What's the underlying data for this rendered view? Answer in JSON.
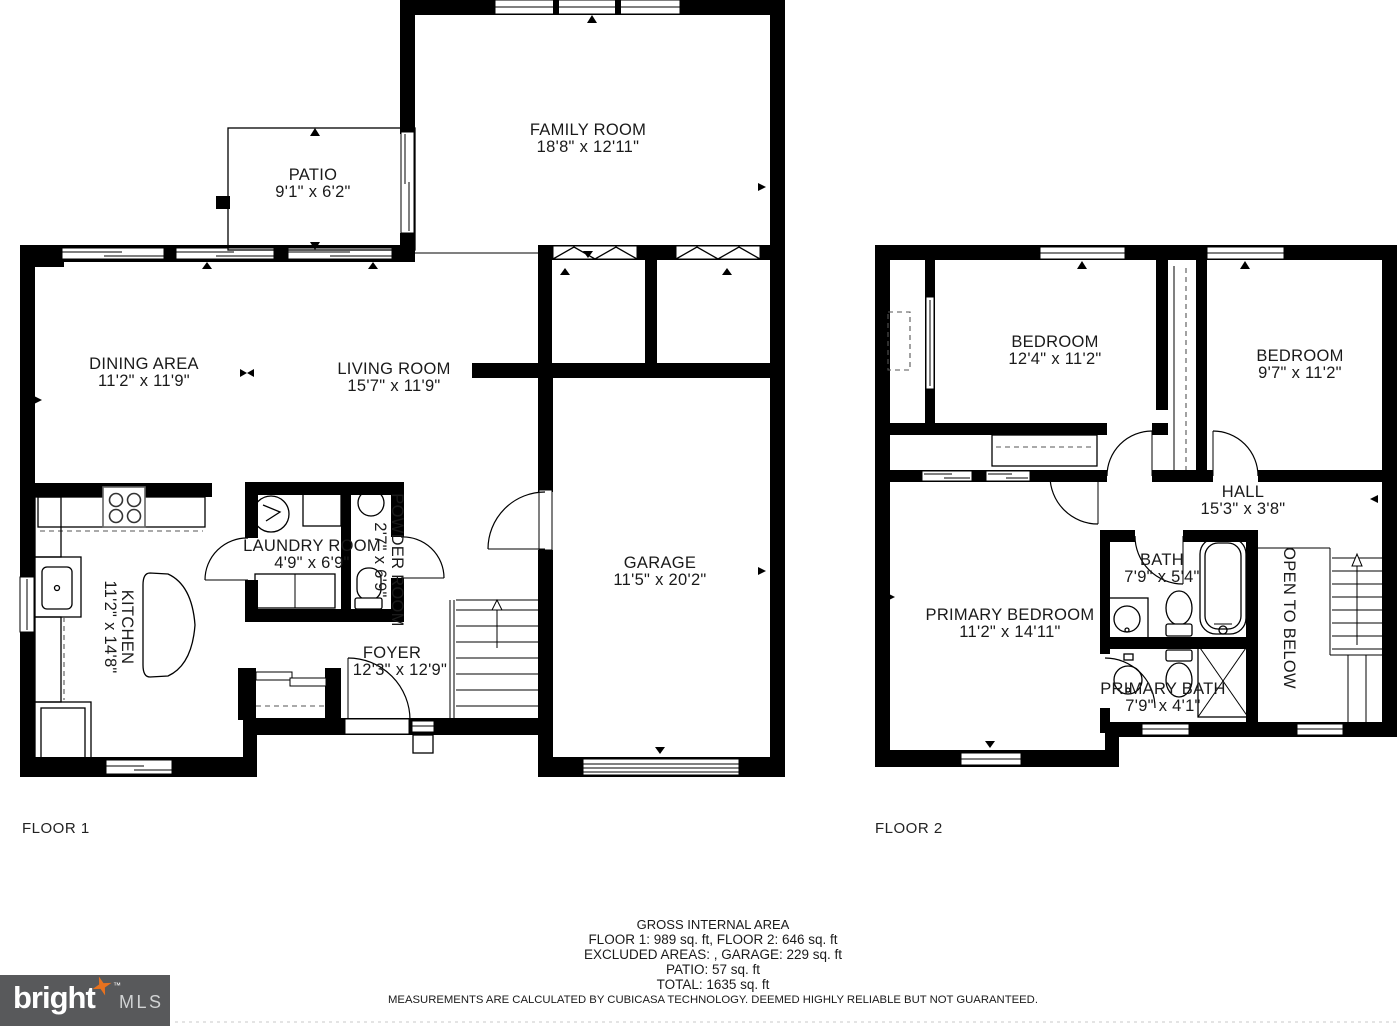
{
  "floor1": {
    "label": "FLOOR 1",
    "rooms": {
      "family": {
        "name": "FAMILY ROOM",
        "dims": "18'8\" x 12'11\""
      },
      "patio": {
        "name": "PATIO",
        "dims": "9'1\" x 6'2\""
      },
      "dining": {
        "name": "DINING AREA",
        "dims": "11'2\" x 11'9\""
      },
      "living": {
        "name": "LIVING ROOM",
        "dims": "15'7\" x 11'9\""
      },
      "kitchen": {
        "name": "KITCHEN",
        "dims": "11'2\" x 14'8\""
      },
      "laundry": {
        "name": "LAUNDRY ROOM",
        "dims": "4'9\" x 6'9\""
      },
      "powder": {
        "name": "POWDER ROOM",
        "dims": "2'7\" x 6'9\""
      },
      "foyer": {
        "name": "FOYER",
        "dims": "12'3\" x 12'9\""
      },
      "garage": {
        "name": "GARAGE",
        "dims": "11'5\" x 20'2\""
      }
    }
  },
  "floor2": {
    "label": "FLOOR 2",
    "rooms": {
      "bedroom1": {
        "name": "BEDROOM",
        "dims": "12'4\" x 11'2\""
      },
      "bedroom2": {
        "name": "BEDROOM",
        "dims": "9'7\" x 11'2\""
      },
      "hall": {
        "name": "HALL",
        "dims": "15'3\" x 3'8\""
      },
      "primary_bedroom": {
        "name": "PRIMARY BEDROOM",
        "dims": "11'2\" x 14'11\""
      },
      "bath": {
        "name": "BATH",
        "dims": "7'9\" x 5'4\""
      },
      "primary_bath": {
        "name": "PRIMARY BATH",
        "dims": "7'9\" x 4'1\""
      },
      "open_below": {
        "name": "OPEN TO BELOW"
      }
    }
  },
  "summary": {
    "title": "GROSS INTERNAL AREA",
    "floors_line": "FLOOR 1: 989 sq. ft, FLOOR 2: 646 sq. ft",
    "excluded_line": "EXCLUDED AREAS: , GARAGE: 229 sq. ft",
    "patio_line": "PATIO: 57 sq. ft",
    "total_line": "TOTAL: 1635 sq. ft",
    "disclaimer": "MEASUREMENTS ARE CALCULATED BY CUBICASA TECHNOLOGY. DEEMED HIGHLY RELIABLE BUT NOT GUARANTEED."
  },
  "logo": {
    "brand": "bright",
    "tm": "™",
    "suffix": "MLS"
  },
  "colors": {
    "wall": "#000000",
    "background": "#ffffff",
    "label_text": "#1a1a1a",
    "logo_background": "#58595b",
    "logo_brand": "#ffffff",
    "logo_mls": "#d1d3d4",
    "logo_star": "#e8721f"
  }
}
